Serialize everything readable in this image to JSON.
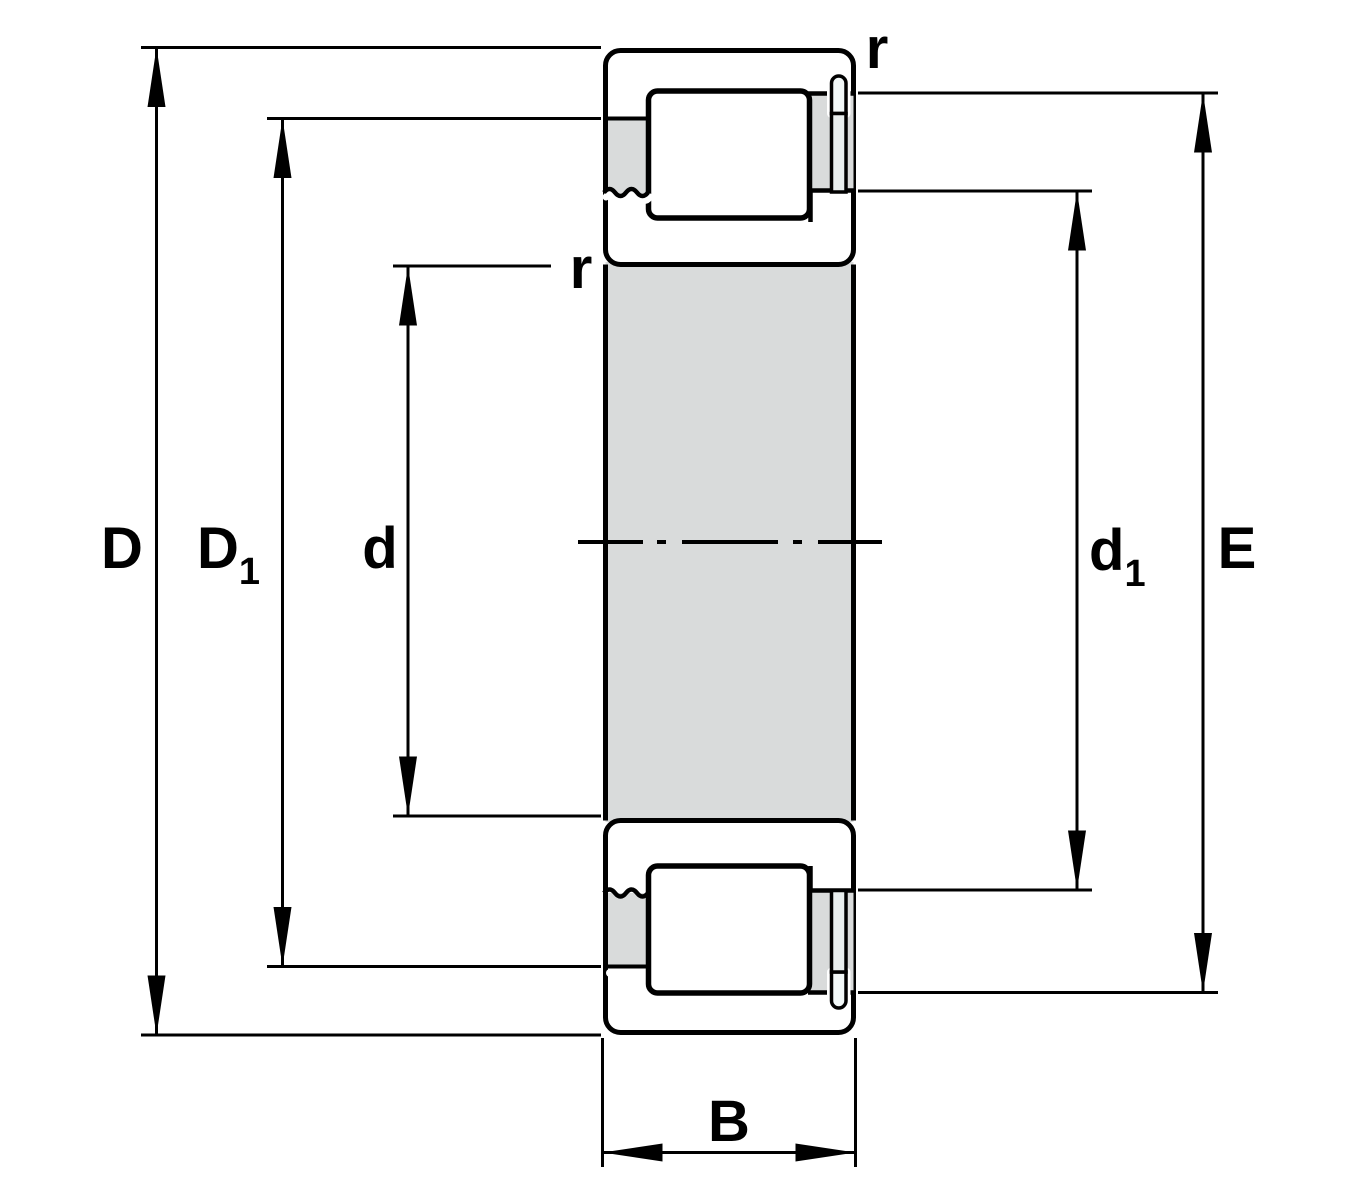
{
  "diagram": {
    "type": "bearing-cross-section-dimension-drawing",
    "labels": {
      "outer_diameter": "D",
      "outer_shoulder_diameter": {
        "main": "D",
        "sub": "1"
      },
      "bore_diameter": "d",
      "inner_shoulder_diameter": {
        "main": "d",
        "sub": "1"
      },
      "raceway_diameter": "E",
      "width": "B",
      "chamfer_radius_outer": "r",
      "chamfer_radius_inner": "r"
    },
    "colors": {
      "background": "#ffffff",
      "outline": "#000000",
      "ring": "#aed6d4",
      "steel": "#d9dbdb",
      "highlight": "#ffffff",
      "pin_body": "#e8eeee",
      "pin_cap": "#f2f8f8",
      "roller_edge_dark": "#84a6ae",
      "roller_upper": "#a9cbd1",
      "roller_light": "#ffffff",
      "roller_lower_light": "#f3f9f9",
      "roller_edge_bottom": "#a2c9cd"
    }
  }
}
